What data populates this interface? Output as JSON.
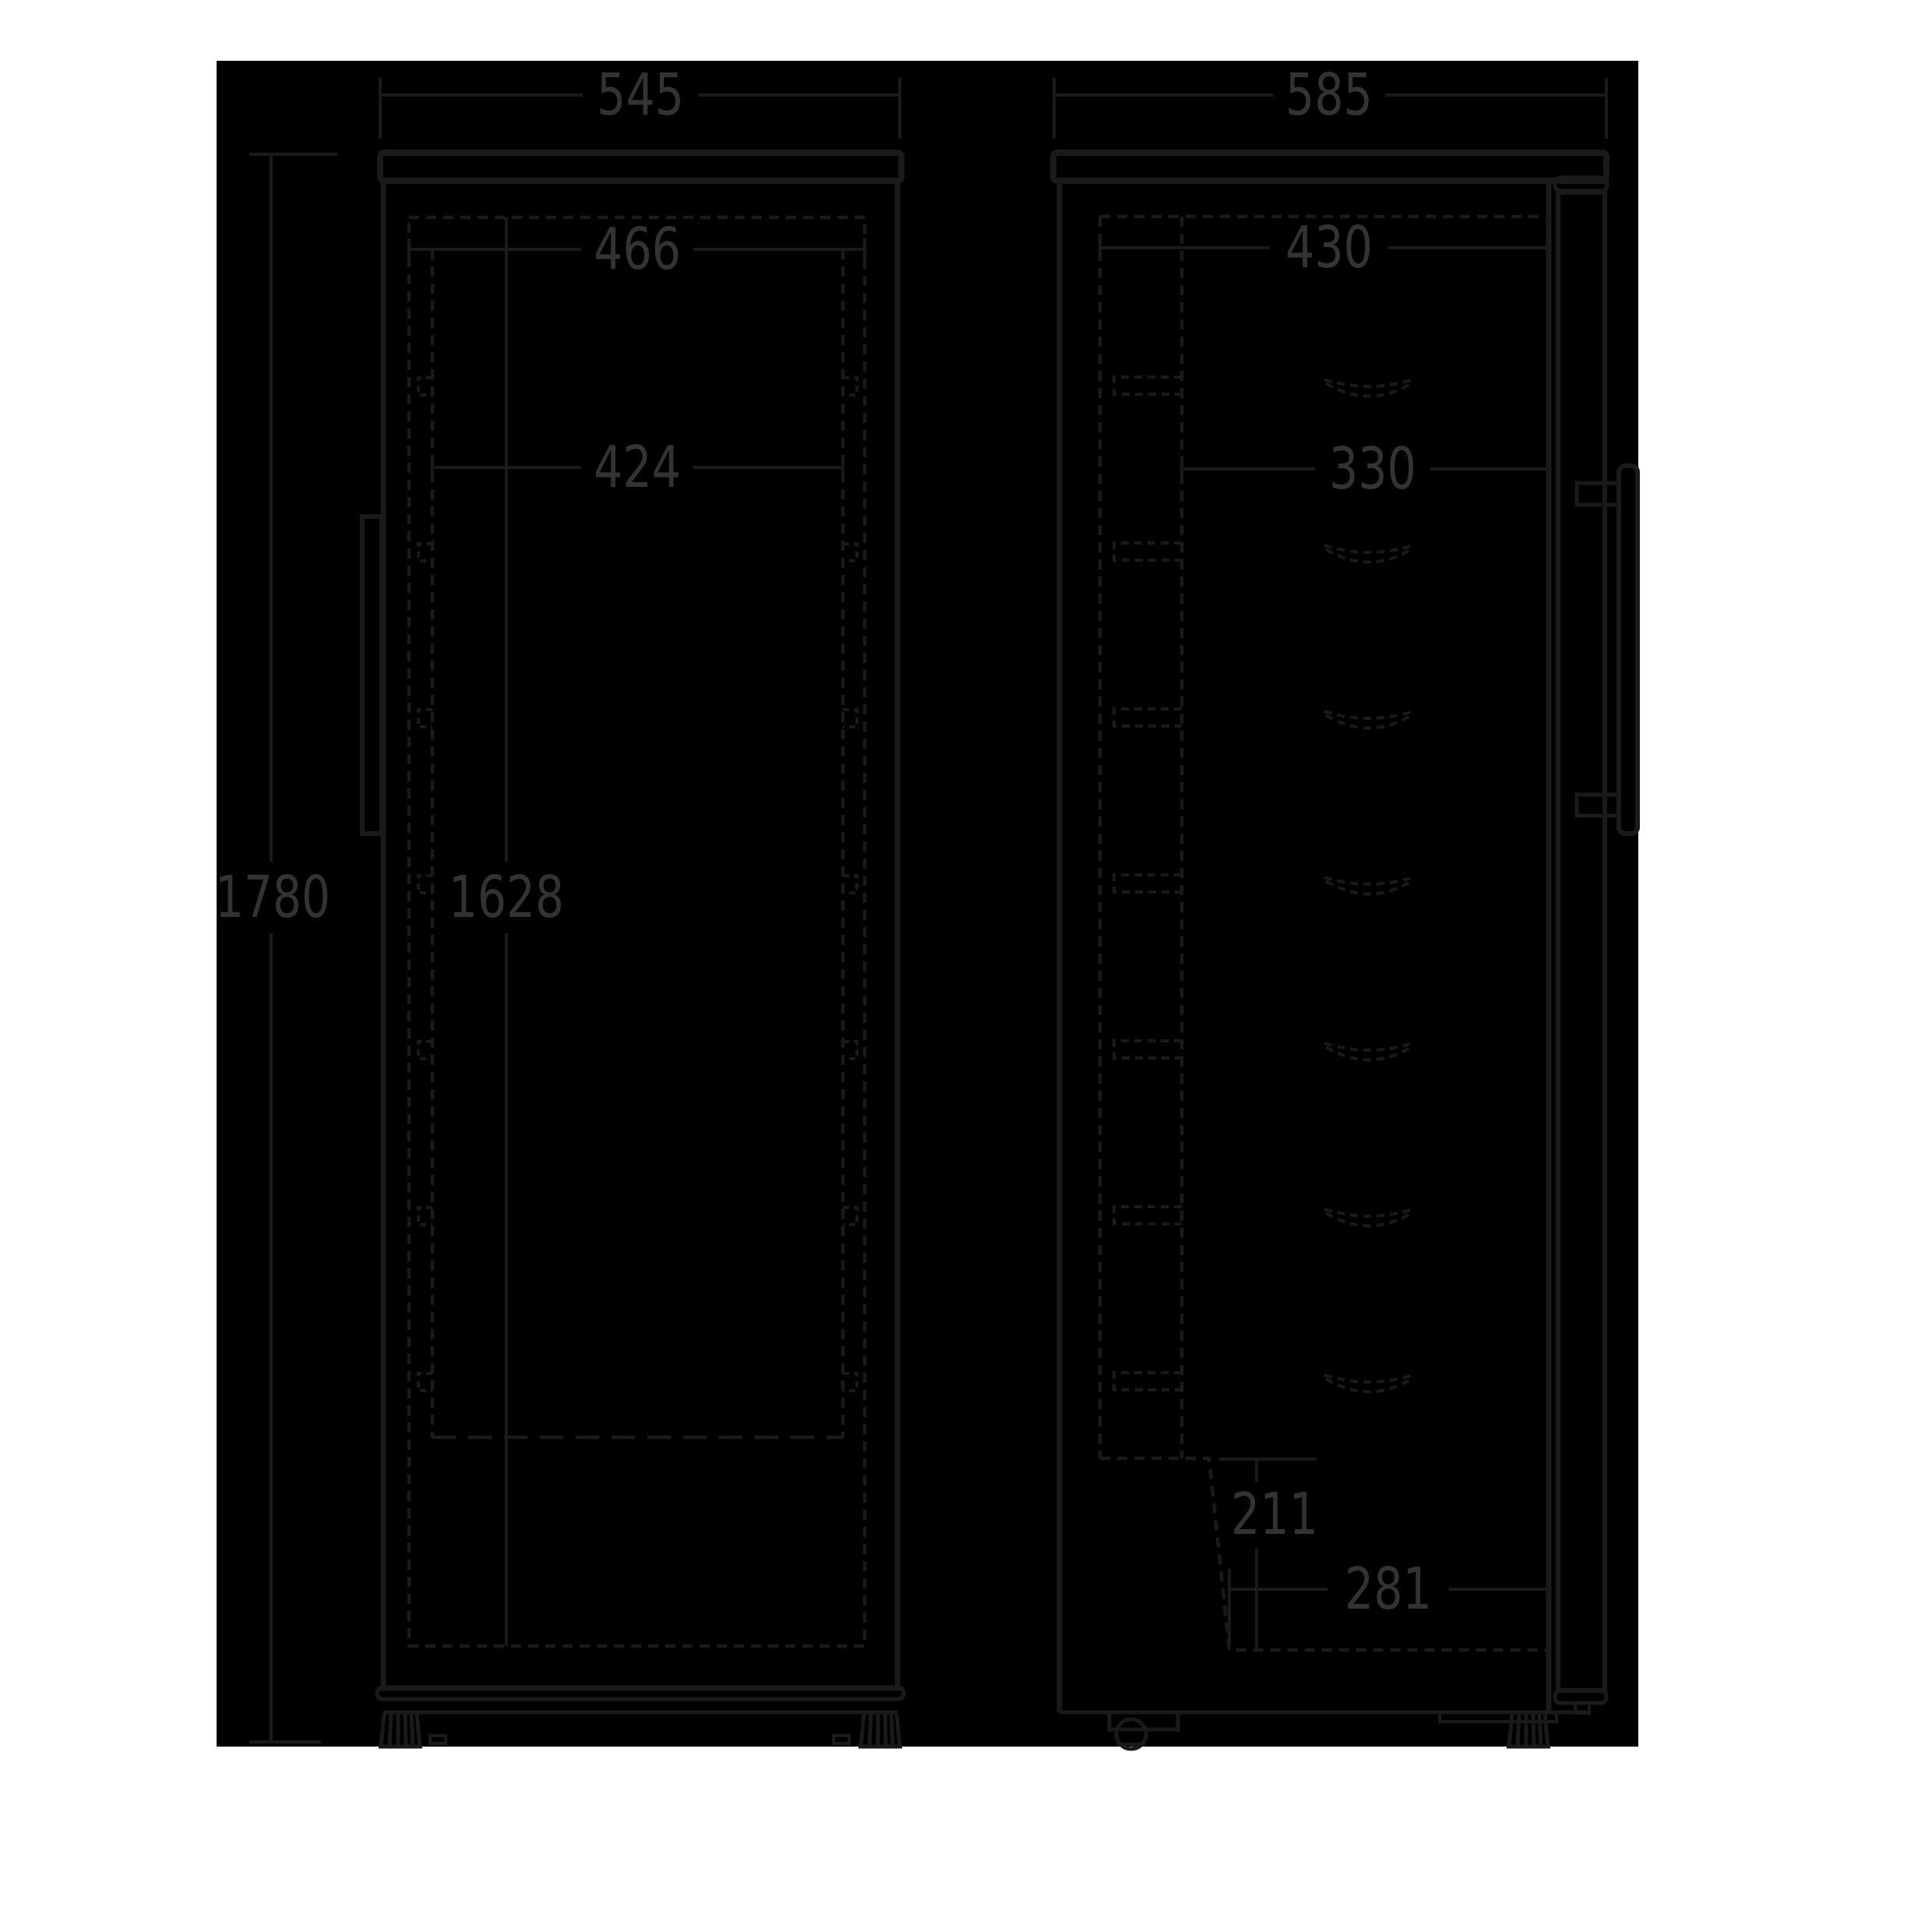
{
  "drawing": {
    "canvas_color": "#000000",
    "line_color": "#1a1a1a",
    "label_color": "#333333",
    "front_view": {
      "width": "545",
      "opening_width": "466",
      "inner_width": "424",
      "height": "1780",
      "inner_height": "1628",
      "shelf_count": 7
    },
    "side_view": {
      "depth": "585",
      "inner_depth": "430",
      "shelf_depth": "330",
      "base_height": "211",
      "base_depth": "281",
      "shelf_count": 7
    }
  }
}
